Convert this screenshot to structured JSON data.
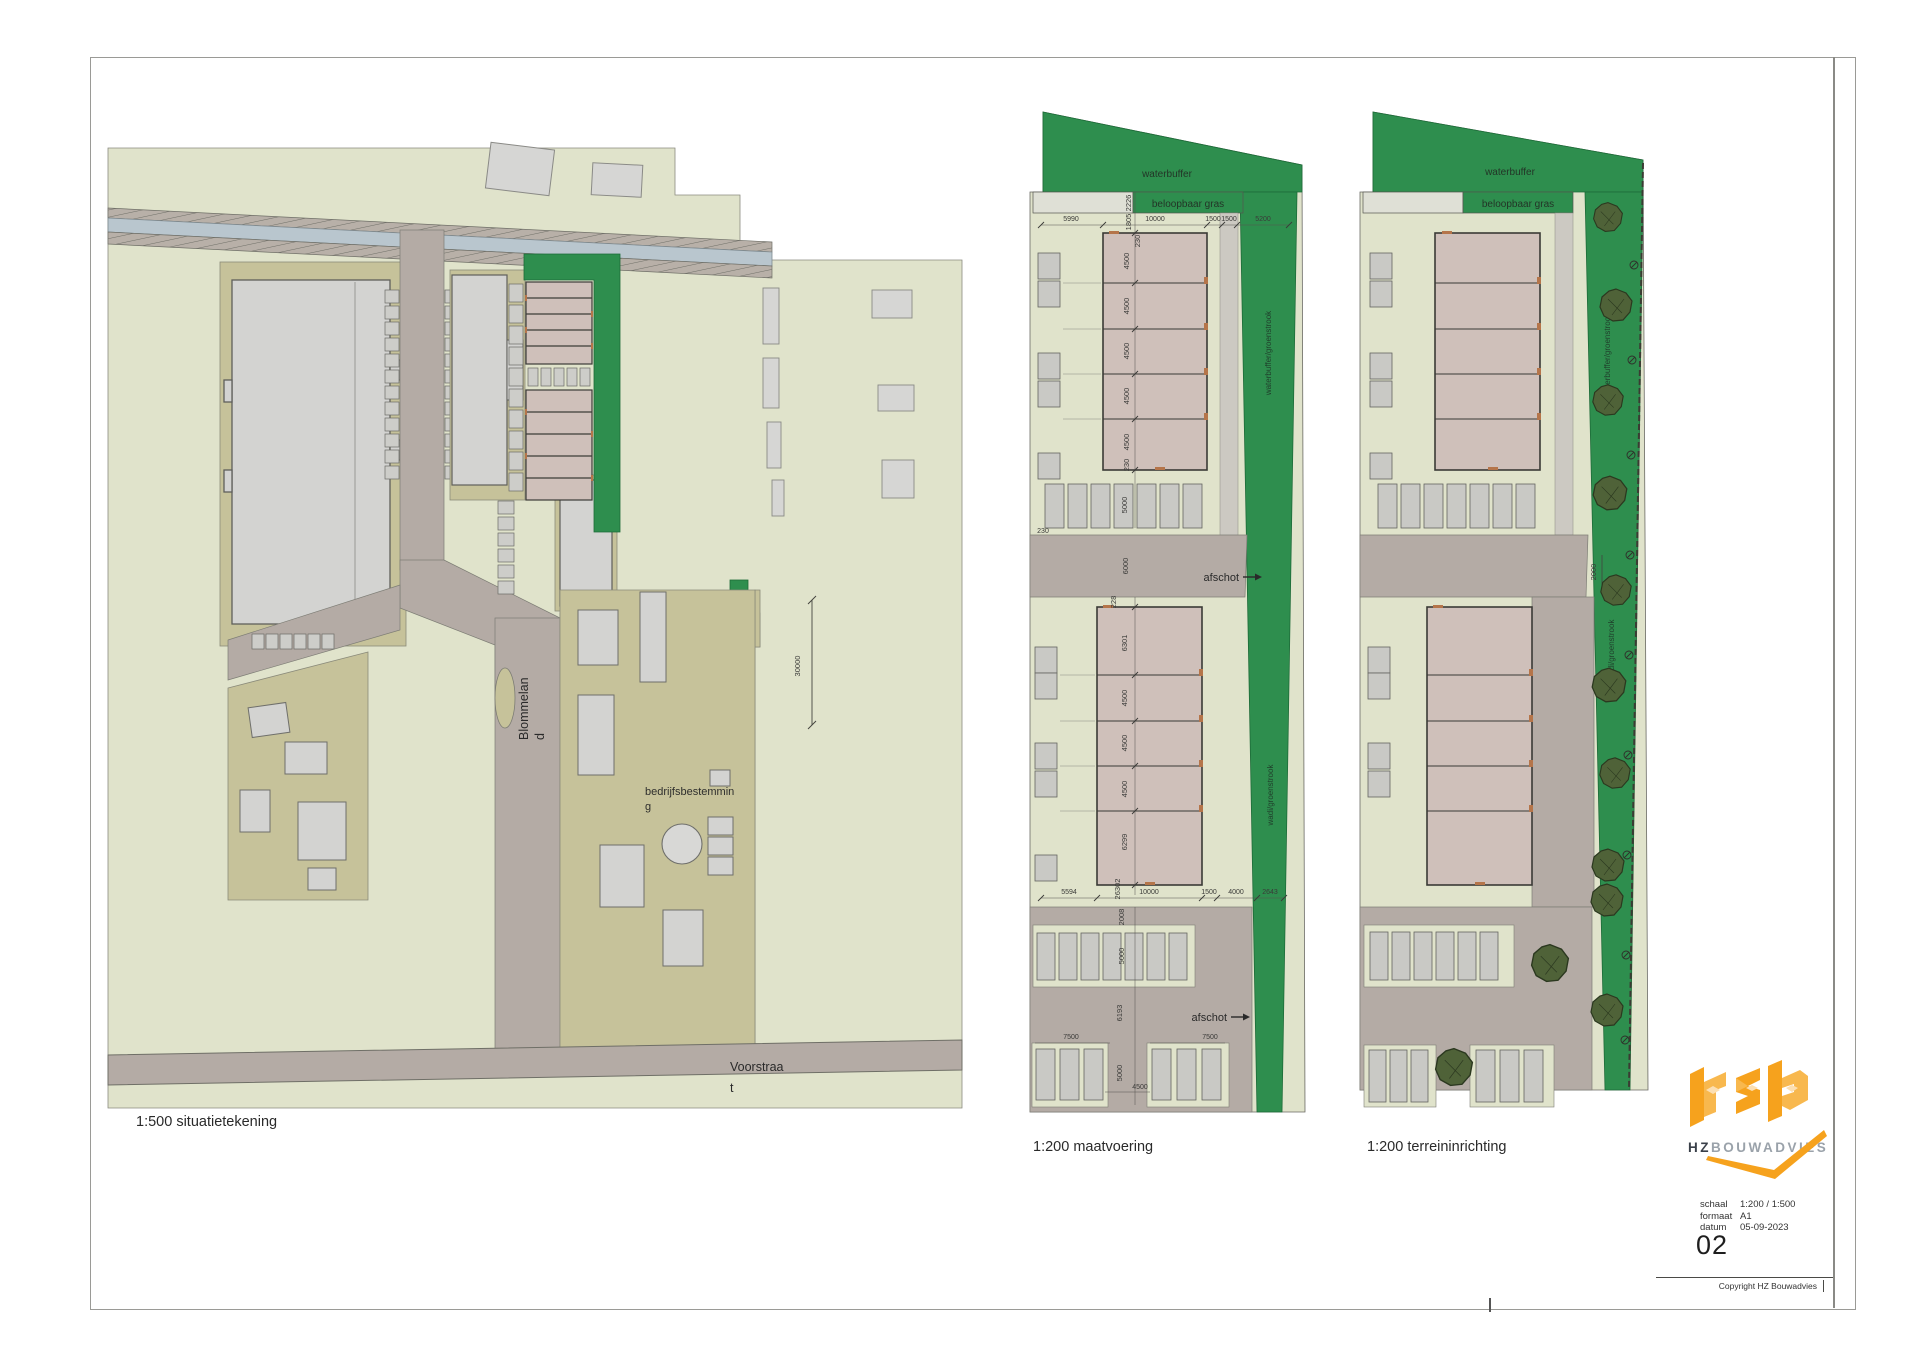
{
  "colors": {
    "land": "#e0e3cb",
    "khaki": "#c6c29a",
    "green": "#2e8e4e",
    "road": "#b4aba5",
    "building_gray": "#d3d3d1",
    "building_pink": "#cfc0ba",
    "canal": "#b9c6ce",
    "tree": "#4f6238",
    "accent_orange_ticks": "#b5754a",
    "logo_orange": "#f6a21d",
    "brand_dark": "#3a4049",
    "brand_gray": "#9aa2aa"
  },
  "plans": {
    "left": {
      "caption": "1:500 situatietekening",
      "street": [
        "Blommelan",
        "d"
      ],
      "area": [
        "bedrijfsbestemmin",
        "g"
      ],
      "road": [
        "Voorstraa",
        "t"
      ],
      "dim": "30000"
    },
    "middle": {
      "caption": "1:200 maatvoering",
      "waterbuffer": "waterbuffer",
      "gras": "beloopbaar gras",
      "strip_upper": "waterbuffer/groenstrook",
      "strip_lower": "wadi/groenstrook",
      "afschot": "afschot",
      "dims": {
        "top": [
          "5990",
          "10000",
          "1500",
          "1500",
          "5200"
        ],
        "left_v": [
          "2226",
          "1805",
          "230"
        ],
        "units1": [
          "4500",
          "4500",
          "4500",
          "4500",
          "4500"
        ],
        "b1": [
          "230",
          "5000"
        ],
        "road": [
          "230",
          "6000"
        ],
        "units2": [
          "228",
          "6301",
          "4500",
          "4500",
          "4500",
          "6299",
          "26302"
        ],
        "bottom": [
          "5594",
          "10000",
          "1500",
          "4000",
          "2643"
        ],
        "lower": [
          "2008",
          "5000",
          "6193",
          "7500",
          "7500",
          "5000",
          "4500"
        ]
      }
    },
    "right": {
      "caption": "1:200 terreininrichting",
      "waterbuffer": "waterbuffer",
      "gras": "beloopbaar gras",
      "strip_upper": "waterbuffer/groenstrook",
      "strip_lower": "wadi/groenstrook",
      "dim": "2000"
    }
  },
  "titleblock": {
    "brand_bold": "HZ",
    "brand_light": "BOUWADVIES",
    "fields": [
      {
        "label": "schaal",
        "value": "1:200 / 1:500"
      },
      {
        "label": "formaat",
        "value": "A1"
      },
      {
        "label": "datum",
        "value": "05-09-2023"
      }
    ],
    "sheet_number": "02",
    "copyright": "Copyright HZ Bouwadvies"
  }
}
